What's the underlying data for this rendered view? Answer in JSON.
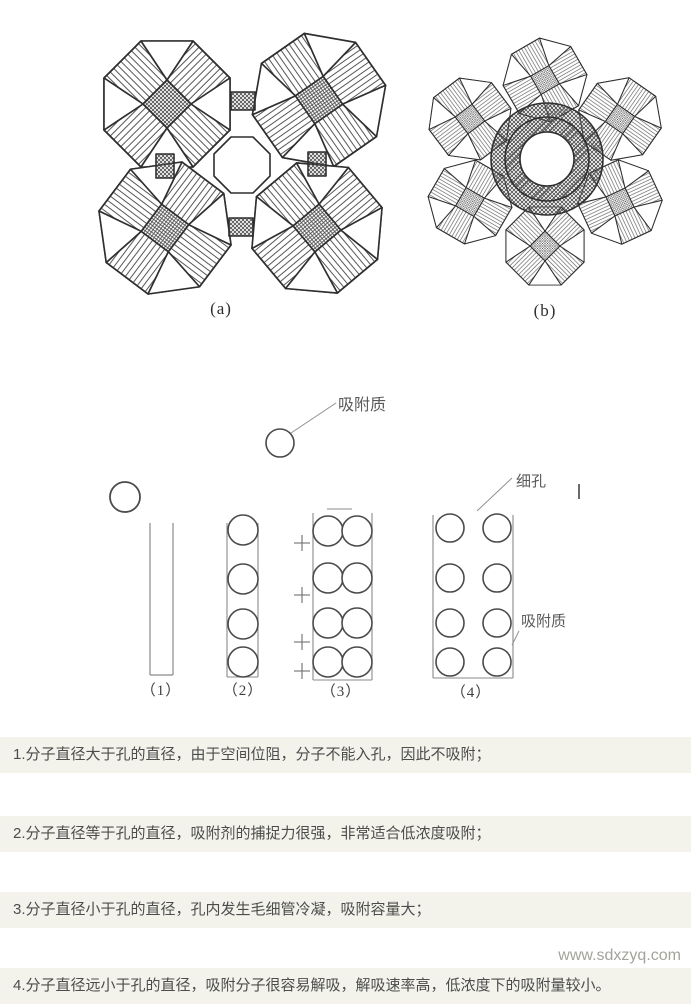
{
  "figures": {
    "label_a": "(a)",
    "label_b": "(b)"
  },
  "pore_diagram": {
    "adsorbate_label_top": "吸附质",
    "fine_pore_label": "细孔",
    "adsorbate_label_right": "吸附质",
    "column_labels": [
      "（1）",
      "（2）",
      "（3）",
      "（4）"
    ]
  },
  "notes": [
    "1.分子直径大于孔的直径，由于空间位阻，分子不能入孔，因此不吸附；",
    "2.分子直径等于孔的直径，吸附剂的捕捉力很强，非常适合低浓度吸附；",
    "3.分子直径小于孔的直径，孔内发生毛细管冷凝，吸附容量大；",
    "4.分子直径远小于孔的直径，吸附分子很容易解吸，解吸速率高，低浓度下的吸附量较小。"
  ],
  "watermark": "www.sdxzyq.com",
  "colors": {
    "note_background": "#f3f3ec",
    "note_text": "#4c4c4c",
    "ink": "#2f2f2f",
    "watermark": "#a3a39c"
  }
}
